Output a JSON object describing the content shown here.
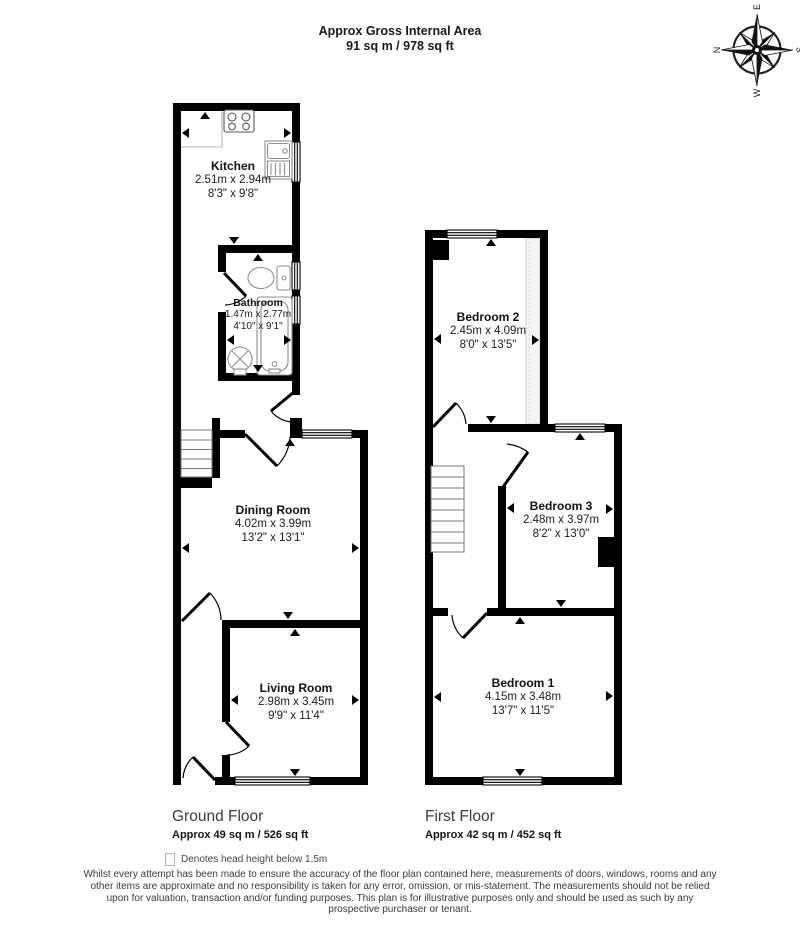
{
  "header": {
    "title": "Approx Gross Internal Area",
    "area": "91 sq m / 978 sq ft"
  },
  "compass": {
    "north": "N",
    "east": "E",
    "south": "S",
    "west": "W"
  },
  "ground_floor": {
    "title": "Ground Floor",
    "area": "Approx 49 sq m / 526 sq ft",
    "rooms": {
      "kitchen": {
        "name": "Kitchen",
        "metric": "2.51m x 2.94m",
        "imperial": "8'3\" x 9'8\""
      },
      "bathroom": {
        "name": "Bathroom",
        "metric": "1.47m x 2.77m",
        "imperial": "4'10\" x 9'1\""
      },
      "dining_room": {
        "name": "Dining Room",
        "metric": "4.02m x 3.99m",
        "imperial": "13'2\" x 13'1\""
      },
      "living_room": {
        "name": "Living Room",
        "metric": "2.98m x 3.45m",
        "imperial": "9'9\" x 11'4\""
      }
    }
  },
  "first_floor": {
    "title": "First Floor",
    "area": "Approx 42 sq m / 452 sq ft",
    "rooms": {
      "bedroom_2": {
        "name": "Bedroom 2",
        "metric": "2.45m x 4.09m",
        "imperial": "8'0\" x 13'5\""
      },
      "bedroom_3": {
        "name": "Bedroom 3",
        "metric": "2.48m x 3.97m",
        "imperial": "8'2\" x 13'0\""
      },
      "bedroom_1": {
        "name": "Bedroom 1",
        "metric": "4.15m x 3.48m",
        "imperial": "13'7\" x 11'5\""
      }
    }
  },
  "legend": {
    "text": "Denotes head height below 1.5m"
  },
  "disclaimer": "Whilst every attempt has been made to ensure the accuracy of the floor plan contained here, measurements of doors, windows, rooms and any other items are approximate and no responsibility is taken for any error, omission, or mis-statement. The measurements should not be relied upon for valuation, transaction and/or funding purposes. This plan is for illustrative purposes only and should be used as such by any prospective purchaser or tenant.",
  "colors": {
    "wall": "#000000",
    "fixture_outline": "#8f8f8f",
    "head_height_fill": "#f4f4f4",
    "head_height_border": "#cccccc"
  }
}
